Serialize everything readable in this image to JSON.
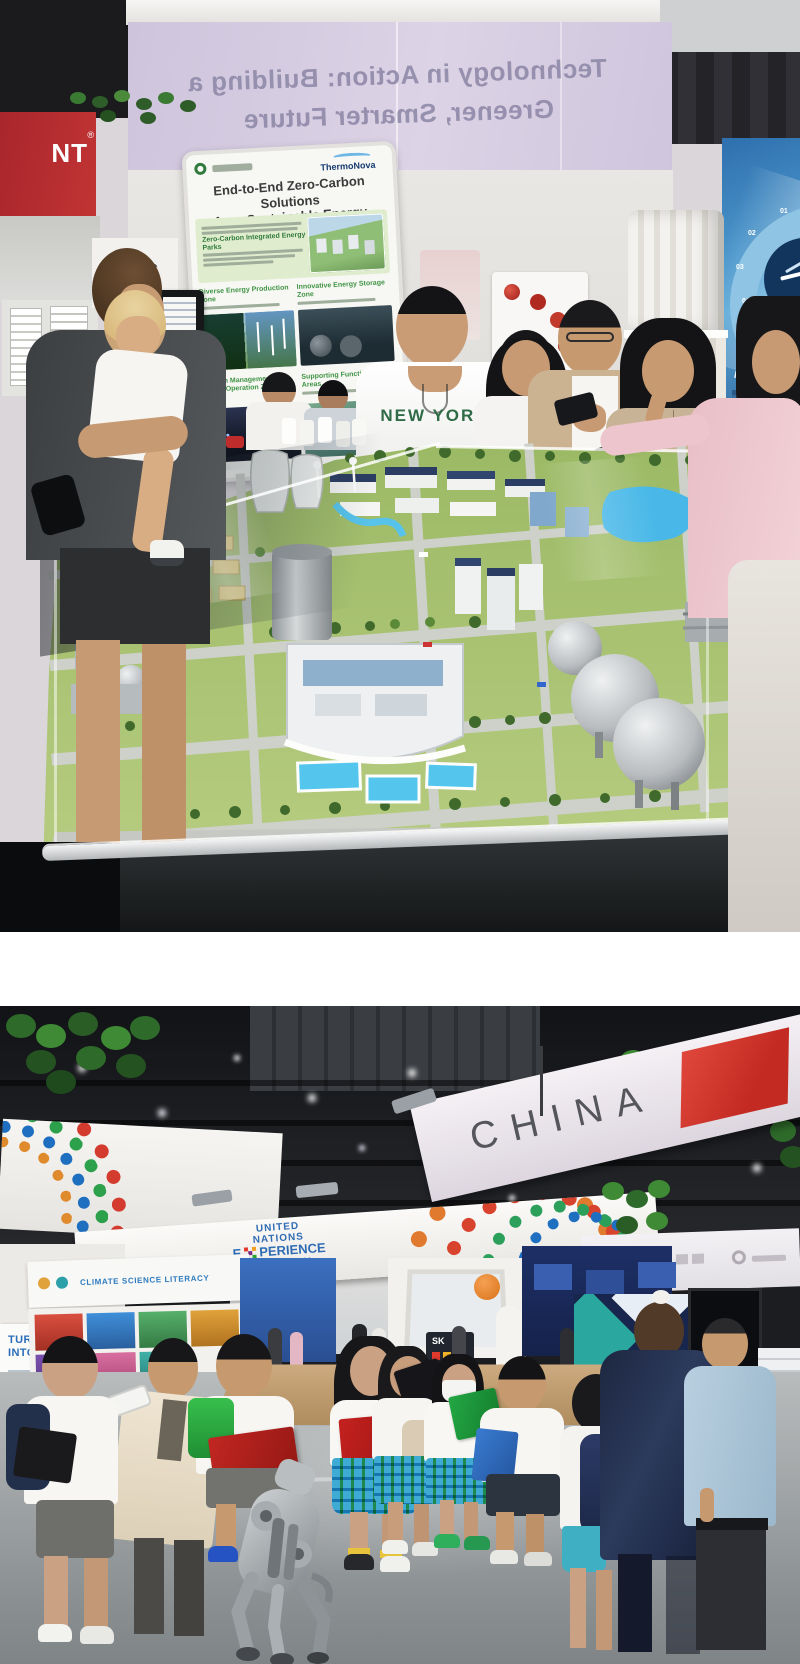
{
  "colors": {
    "banner_lavender": "#d3c9e0",
    "sign_green": "#3f9444",
    "thermonova_navy": "#143a6e",
    "un_blue": "#2f6cb4",
    "china_red": "#cf3028",
    "model_grass": "#a8c272",
    "water_blue": "#45b7e8",
    "plaid_skirt": "#7fd0e8",
    "clipboard_red": "#b8221f",
    "clipboard_green": "#1f9e3a"
  },
  "photo_top": {
    "ceiling_banner": {
      "line1": "Technology in Action: Building a",
      "line2": "Greener, Smarter Future"
    },
    "left_red_banner": "NT",
    "left_reg": "®",
    "scc_logo": "SCC",
    "sign": {
      "brand": "ThermoNova",
      "title_line1": "End-to-End Zero-Carbon Solutions",
      "title_line2": "for a Sustainable Energy Ecosystem",
      "intro_bold": "Zero-Carbon Integrated Energy Parks",
      "zones": [
        "Diverse Energy Production Zone",
        "Innovative Energy Storage Zone",
        "Carbon Management & Smart Operation Zone",
        "Supporting Functional Areas"
      ]
    },
    "tshirt": "NEW YORK",
    "wheel_poster": {
      "label": "Product",
      "numbers": [
        "01",
        "02",
        "03",
        "04",
        "05"
      ]
    }
  },
  "photo_bottom": {
    "un_banner": {
      "word1": "UNITED",
      "word2": "NATIONS",
      "x_letter": "E",
      "word3": "PERIENCE",
      "word4": "PAVILION"
    },
    "china_banner": "CHINA",
    "left_poster": {
      "line1": "TURNING DATA",
      "line2": "INTO ACTION"
    },
    "climate_header": "CLIMATE SCIENCE LITERACY",
    "sk_sign": "SK",
    "right_panel_partial": "Ther"
  }
}
